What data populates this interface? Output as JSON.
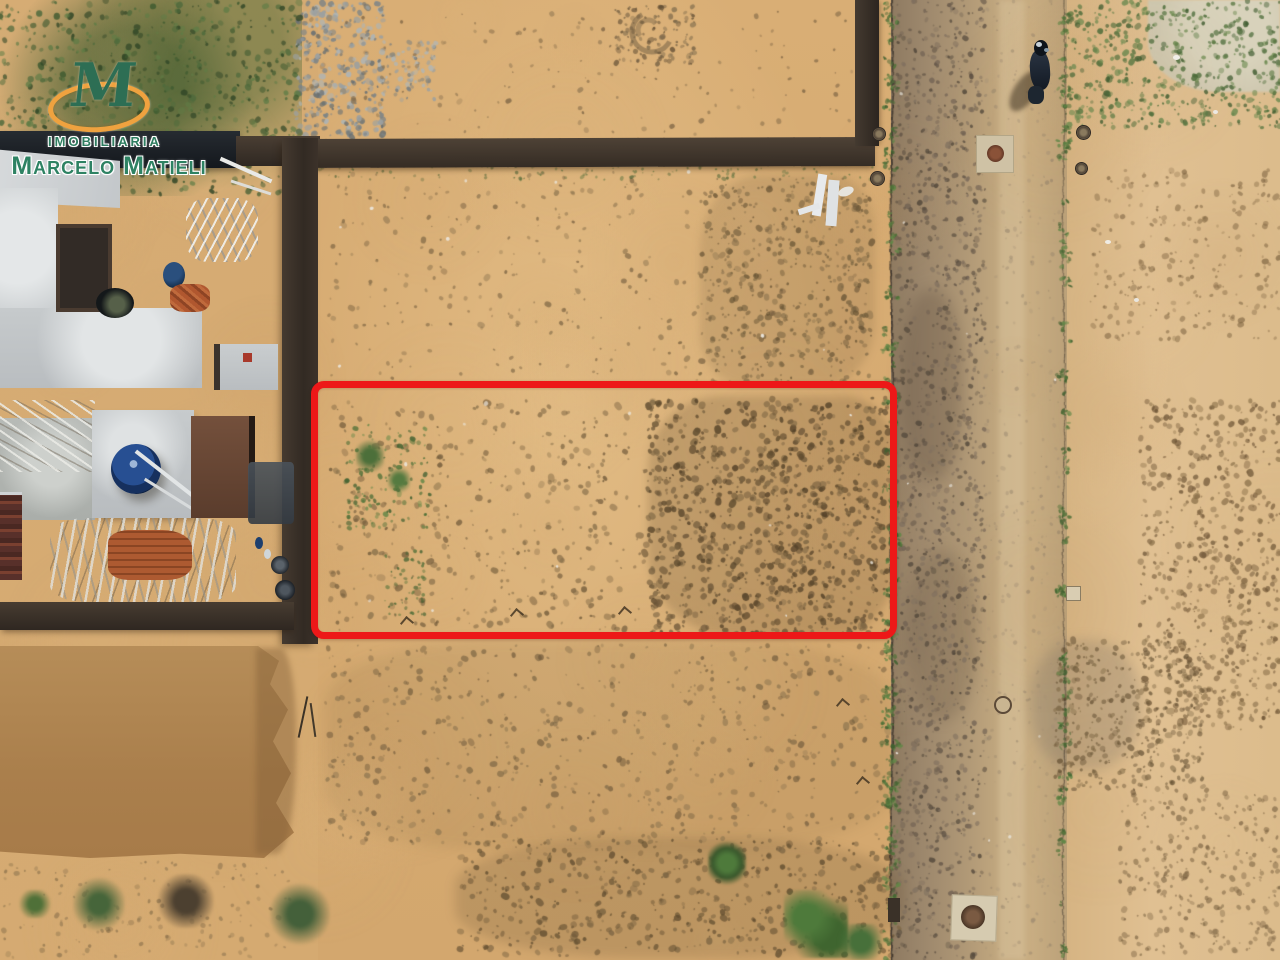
{
  "image": {
    "kind": "aerial-drone-photo",
    "subject": "vacant sandy land plot demarcated with a red rectangle, beside a dirt road and houses under construction"
  },
  "watermark": {
    "monogram": "M",
    "line1": "IMOBILIARIA",
    "line2": "Marcelo Matieli",
    "text_color": "#2e8263",
    "ring_color": "#efa23f",
    "monogram_color": "#2d6e54"
  },
  "plot_marker": {
    "shape": "rectangle",
    "color": "#ed1818"
  },
  "palette": {
    "sand": "#d5ab73",
    "road": "#b29a77",
    "dark_wall": "#372d26",
    "concrete_slab": "#c7cbcd",
    "roof_brown": "#6b4534",
    "water_tank_blue": "#274f92",
    "graded_dirt_pad": "#ad824f",
    "vegetation_green": "#4f7038"
  }
}
